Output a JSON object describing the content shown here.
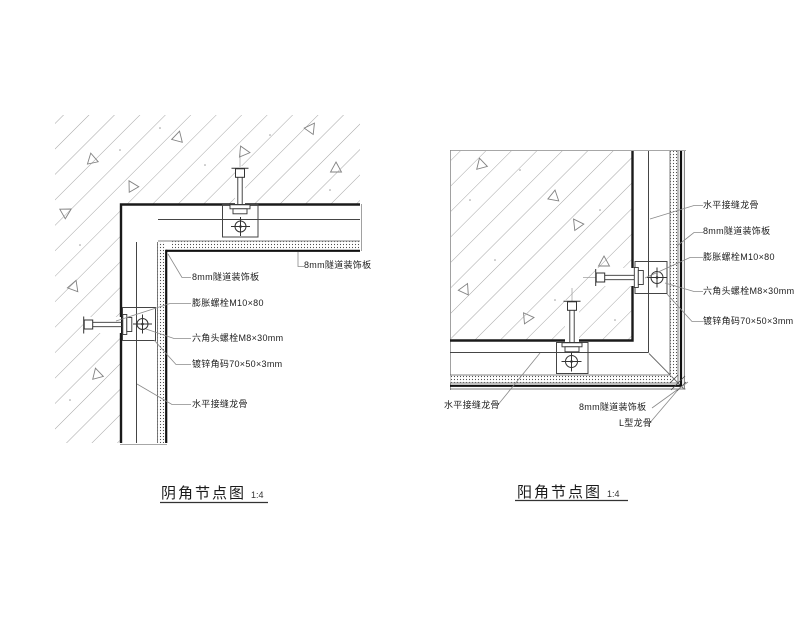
{
  "app": {
    "type": "cad-detail-drawing",
    "background": "#ffffff"
  },
  "colors": {
    "thick_line": "#1a1a1a",
    "medium_line": "#444444",
    "hatch_line": "#a0a0a0",
    "leader_line": "#888888",
    "label_text": "#222222"
  },
  "left_drawing": {
    "title": "阴角节点图",
    "scale": "1:4",
    "labels": {
      "panel": "8mm隧道装饰板",
      "panel_right": "8mm隧道装饰板",
      "expansion_bolt": "膨胀螺栓M10×80",
      "hex_bolt": "六角头螺栓M8×30mm",
      "angle_bracket": "镀锌角码70×50×3mm",
      "horizontal_joint_keel": "水平接缝龙骨"
    }
  },
  "right_drawing": {
    "title": "阳角节点图",
    "scale": "1:4",
    "labels": {
      "horizontal_joint_keel": "水平接缝龙骨",
      "panel": "8mm隧道装饰板",
      "expansion_bolt": "膨胀螺栓M10×80",
      "hex_bolt": "六角头螺栓M8×30mm",
      "angle_bracket": "镀锌角码70×50×3mm",
      "horizontal_joint_keel_bottom": "水平接缝龙骨",
      "panel_bottom": "8mm隧道装饰板",
      "l_keel": "L型龙骨"
    }
  }
}
